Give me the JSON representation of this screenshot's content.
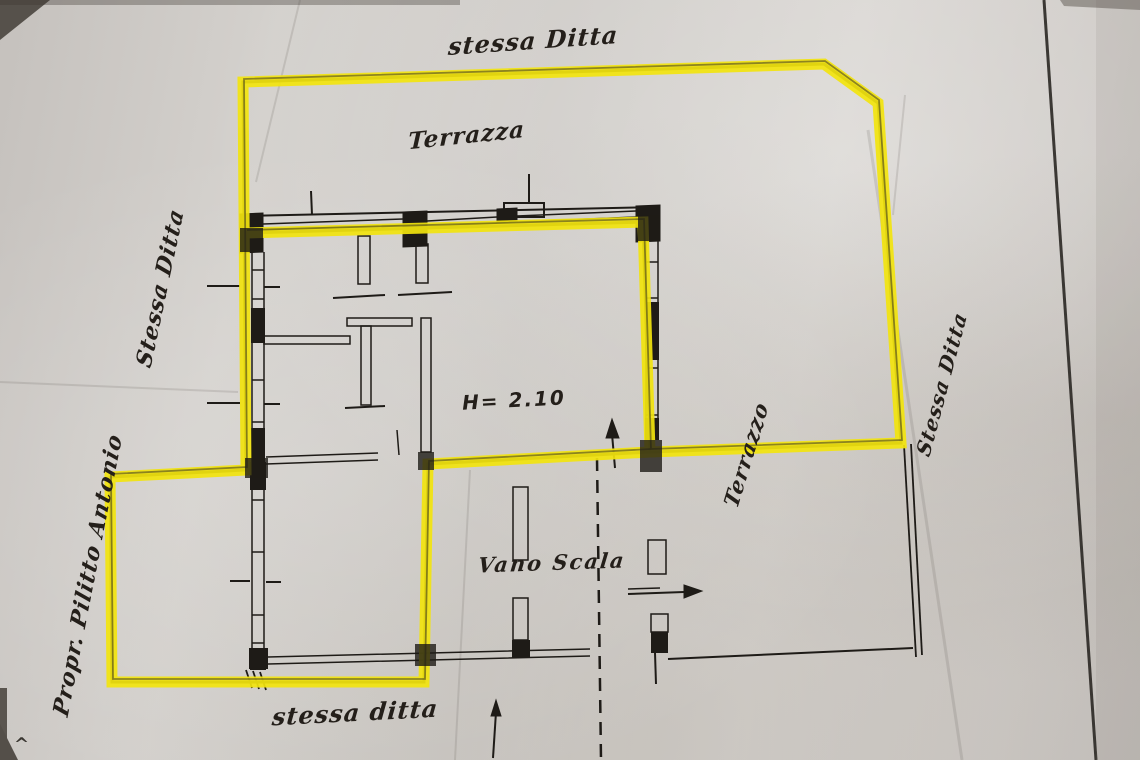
{
  "labels": {
    "top_boundary": "stessa Ditta",
    "terrace_top": "Terrazza",
    "left_boundary": "Stessa Ditta",
    "height_note": "H= 2.10",
    "stairwell": "Vano Scala",
    "terrace_right": "Terrazzo",
    "right_boundary": "Stessa Ditta",
    "owner": "Propr. Pilitto Antonio",
    "bottom_boundary": "stessa ditta",
    "corner_mark": "^"
  },
  "colors": {
    "highlighter": "#f2e40e",
    "ink": "#1e1b17",
    "paper": "#cfccc8",
    "photo_shadow": "#56514b"
  }
}
